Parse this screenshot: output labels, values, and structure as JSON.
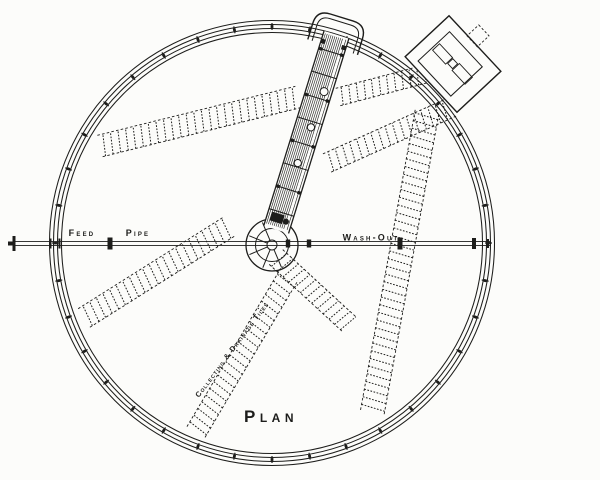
{
  "labels": {
    "feed": "Feed",
    "pipe": "Pipe",
    "washout": "Wash-Out",
    "tiles": "Collecting & Drainage Tiles",
    "plan": "Plan"
  },
  "colors": {
    "ink": "#1d1d1b",
    "paper": "#fcfcfa"
  },
  "geometry": {
    "width": 600,
    "height": 480,
    "center": {
      "x": 272,
      "y": 243
    },
    "rim_radii": [
      210.5,
      214.5,
      218.5,
      222.5
    ],
    "ticks": {
      "count": 36,
      "r_mid": 216.5,
      "len": 7
    },
    "arm": {
      "angle_deg": 17.2,
      "length": 218,
      "half_width": 13
    },
    "hub": {
      "cy_offset": 2,
      "r_outer": 26,
      "r_inner": 16.5,
      "r_boss": 5,
      "spoke_angles": [
        67,
        112,
        157,
        202,
        247
      ]
    },
    "pipe": {
      "y": 243.5,
      "half_gap": 1.9,
      "x_left": 8,
      "x_right": 491,
      "left_flange_x": 14,
      "rim_tick_xs": [
        50.5,
        59.5
      ],
      "left_coupling_x": 110,
      "hub_coupling_xs": [
        288,
        309
      ],
      "right_coupling_x": 400,
      "right_end_x": 474,
      "right_tick_x": 488
    },
    "strips": [
      {
        "x1": 100,
        "y1": 146,
        "x2": 298,
        "y2": 97,
        "w": 22
      },
      {
        "x1": 338,
        "y1": 97,
        "x2": 456,
        "y2": 66,
        "w": 18
      },
      {
        "x1": 327,
        "y1": 163,
        "x2": 452,
        "y2": 107,
        "w": 20
      },
      {
        "x1": 427,
        "y1": 112,
        "x2": 372,
        "y2": 414,
        "w": 24
      },
      {
        "x1": 84,
        "y1": 318,
        "x2": 230,
        "y2": 226,
        "w": 22
      },
      {
        "x1": 196,
        "y1": 432,
        "x2": 289,
        "y2": 275,
        "w": 21
      },
      {
        "x1": 276,
        "y1": 257,
        "x2": 350,
        "y2": 325,
        "w": 20
      }
    ],
    "building": {
      "cx": 453,
      "cy": 64,
      "angle_deg": 47,
      "outer_w": 76,
      "outer_h": 60,
      "inner": {
        "x": -26,
        "y": -19.5,
        "w": 48,
        "h": 43
      },
      "motor_blocks": [
        {
          "x": -24,
          "y": -4,
          "w": 19,
          "h": 9.5
        },
        {
          "x": -4,
          "y": -3.5,
          "w": 7,
          "h": 7
        },
        {
          "x": 4,
          "y": -5,
          "w": 19,
          "h": 10
        }
      ],
      "annex": {
        "x": -11,
        "y": -45.5,
        "w": 15,
        "h": 16
      }
    },
    "label_pos": {
      "feed": {
        "x": 82,
        "y": 236
      },
      "pipe": {
        "x": 138,
        "y": 236
      },
      "washout": {
        "x": 371,
        "y": 240.5
      },
      "tiles": {
        "x": 234,
        "y": 351,
        "angle": -53.2
      },
      "plan": {
        "x": 271,
        "y": 422
      }
    }
  }
}
